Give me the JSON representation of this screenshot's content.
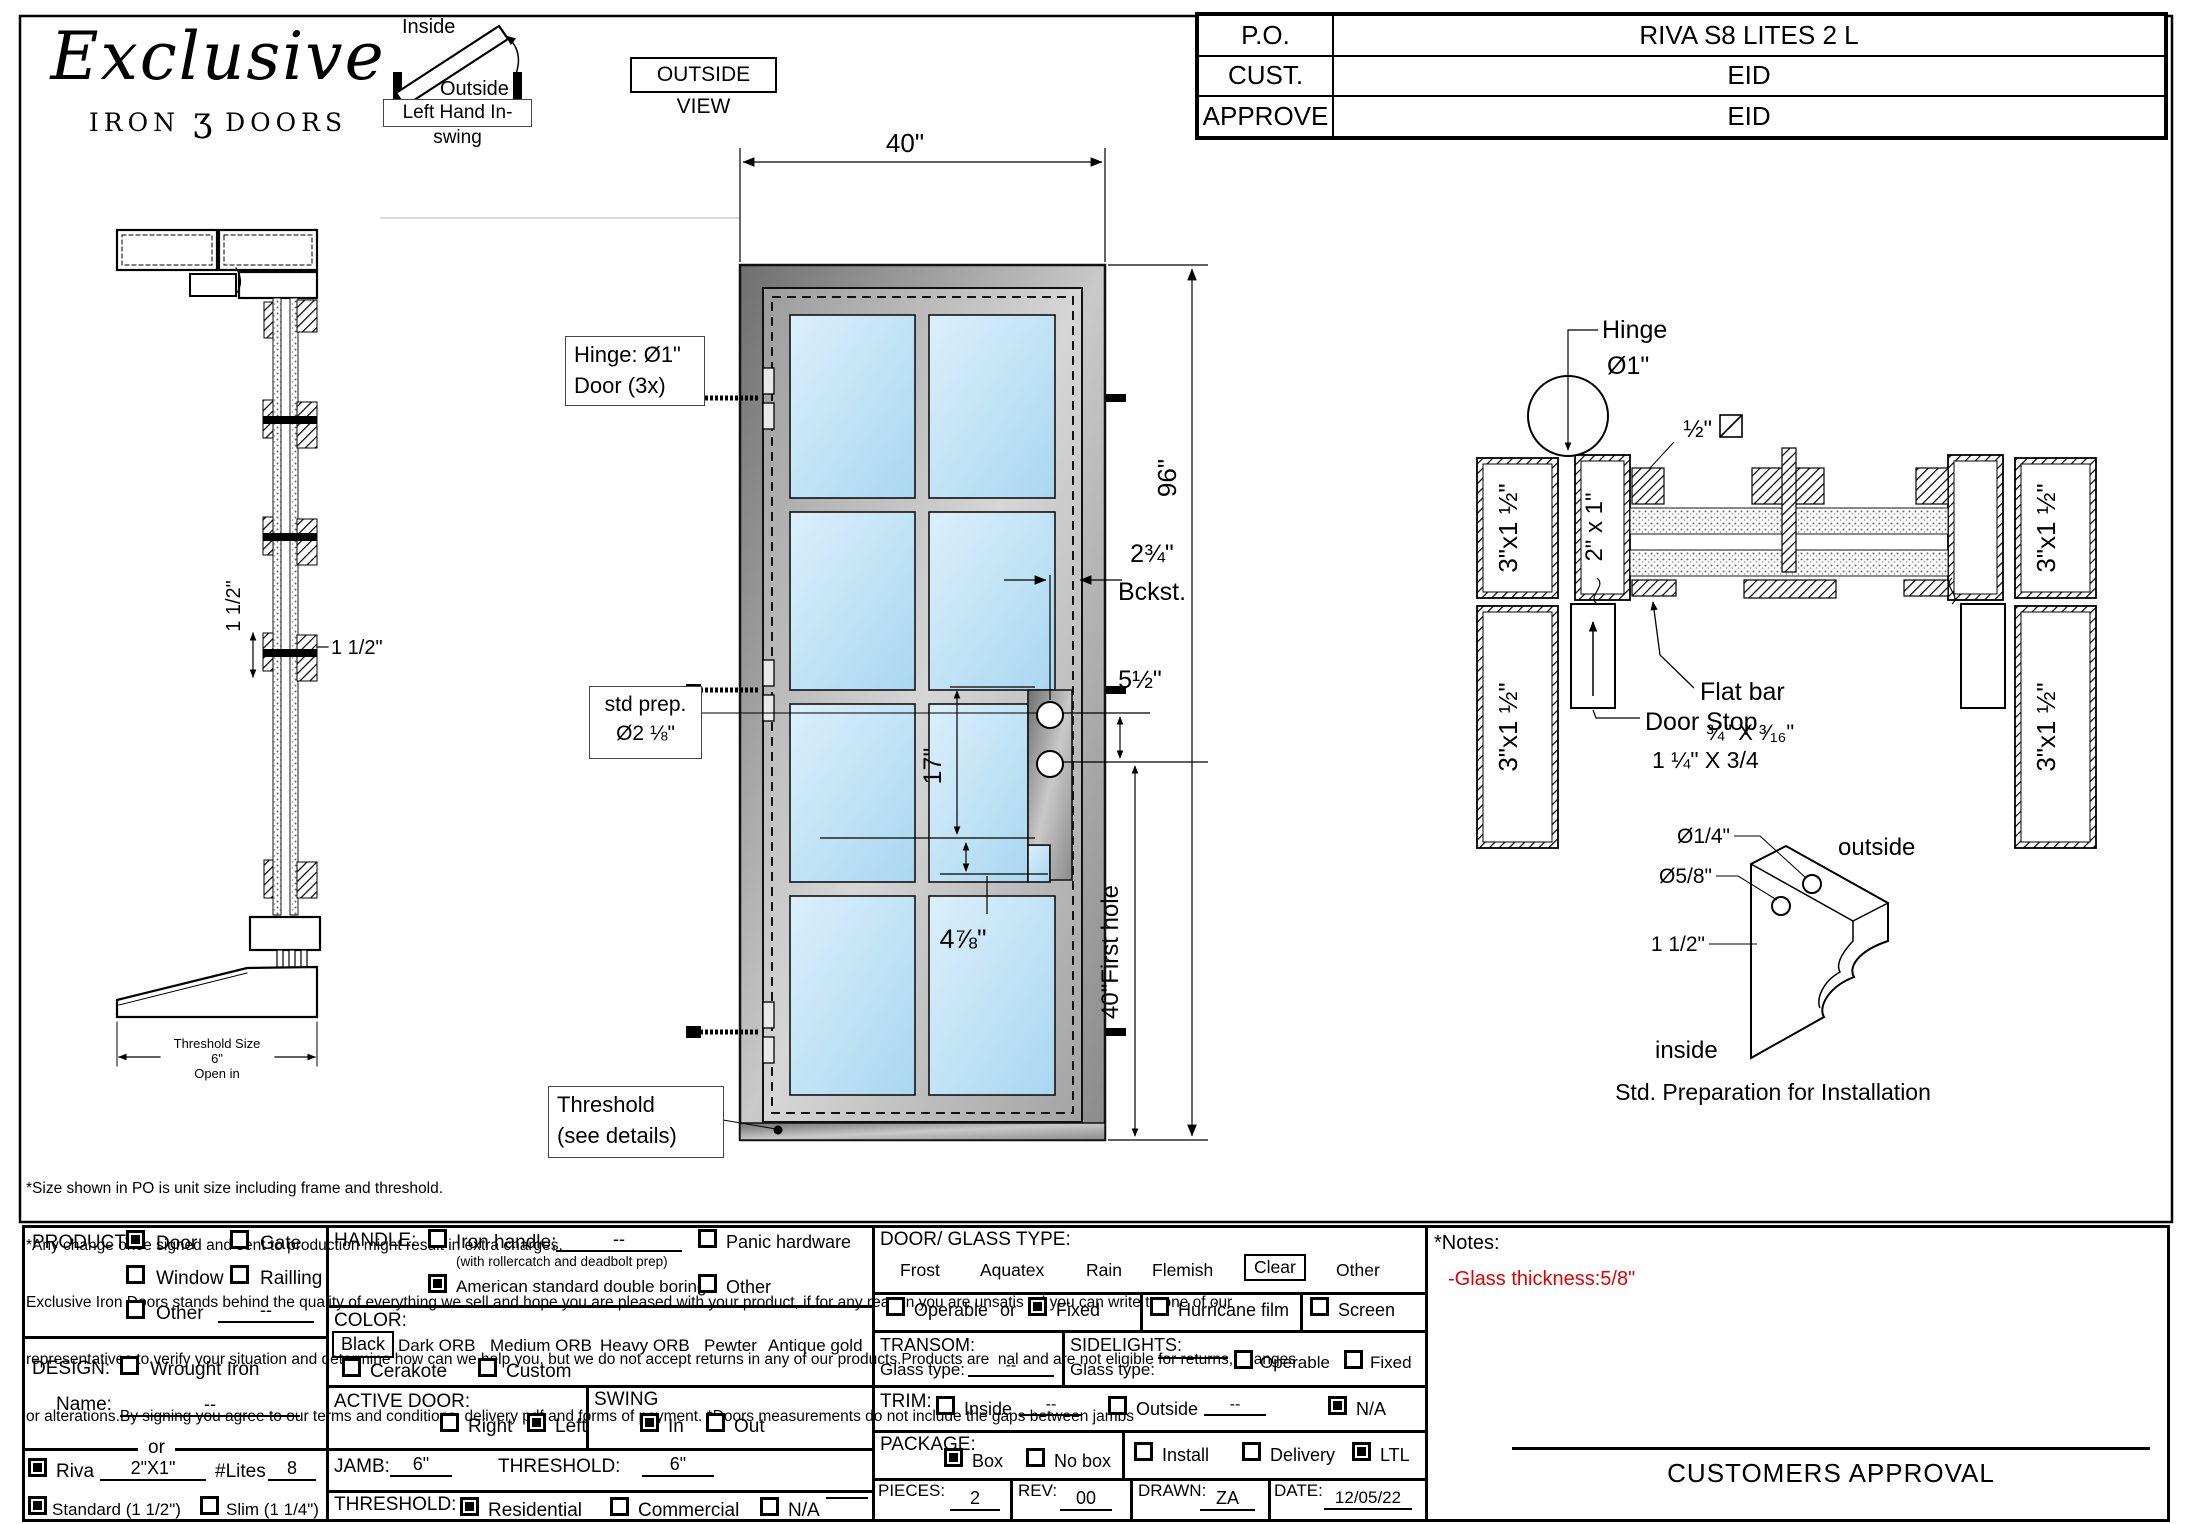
{
  "logo": {
    "name": "Exclusive",
    "iron": "IRON",
    "ornament": "ʒ",
    "doors": "DOORS"
  },
  "swing_diagram": {
    "inside": "Inside",
    "outside": "Outside",
    "caption": "Left Hand In-swing"
  },
  "view_label": "OUTSIDE VIEW",
  "po_table": {
    "r1l": "P.O.",
    "r1v": "RIVA S8 LITES 2 L",
    "r2l": "CUST.",
    "r2v": "EID",
    "r3l": "APPROVE",
    "r3v": "EID"
  },
  "elevation": {
    "width_dim": "40\"",
    "height_dim": "96\"",
    "hinge1": "Hinge: Ø1\"",
    "hinge2": "Door (3x)",
    "prep1": "std prep.",
    "prep2": "Ø2 ⅛\"",
    "backset1": "2¾\"",
    "backset2": "Bckst.",
    "five_half": "5½\"",
    "seventeen": "17\"",
    "four78": "4⅞\"",
    "first_hole": "40\"First hole",
    "thr1": "Threshold",
    "thr2": "(see details)"
  },
  "section": {
    "dim_rot": "1 1/2\"",
    "dim_h": "1 1/2\"",
    "t1": "Threshold Size",
    "t2": "6\"",
    "t3": "Open in"
  },
  "plan": {
    "hinge1": "Hinge",
    "hinge2": "Ø1\"",
    "half": "½\"",
    "tube": "2\" x 1\"",
    "jamb": "3\"x1 ½\"",
    "flat1": "Flat bar",
    "flat2": "¾\" X ³⁄₁₆\"",
    "stop1": "Door Stop",
    "stop2": "1 ¼\" X 3/4"
  },
  "corner": {
    "d14": "Ø1/4\"",
    "d58": "Ø5/8\"",
    "d112": "1 1/2\"",
    "outside": "outside",
    "inside": "inside",
    "caption": "Std. Preparation for Installation"
  },
  "disclaimer": {
    "l1": "*Size shown in PO is unit size including frame and threshold.",
    "l2": "*Any change once signed and sent to production might result in extra charges.",
    "l3": "Exclusive Iron Doors stands behind the quality of everything we sell and hope you are pleased with your product, if for any reason you are unsatis ed you can write to one of our",
    "l4": "representatives to verify your situation and determine how can we help you, but we do not accept returns in any of our products.Products are  nal and are not eligible for returns, changes",
    "l5": "or alterations.By signing you agree to our terms and conditions, delivery pdf and forms of payment. *Doors measurements do not include the gaps between jambs"
  },
  "form": {
    "product": {
      "label": "PRODUCT:",
      "door": "Door",
      "gate": "Gate",
      "window": "Window",
      "railing": "Railling",
      "other": "Other",
      "other_val": "--"
    },
    "design": {
      "label": "DESIGN:",
      "wrought": "Wrought Iron",
      "name_label": "Name:",
      "name_val": "--",
      "or": "or",
      "riva": "Riva",
      "riva_val": "2\"X1\"",
      "lites_label": "#Lites",
      "lites_val": "8",
      "standard": "Standard (1 1/2\")",
      "slim": "Slim (1 1/4\")"
    },
    "handle": {
      "label": "HANDLE:",
      "iron": "Iron handle;",
      "iron_val": "--",
      "note": "(with rollercatch and deadbolt prep)",
      "american": "American standard double boring",
      "panic": "Panic hardware",
      "other": "Other"
    },
    "color": {
      "label": "COLOR:",
      "black": "Black",
      "opt1": "Dark ORB",
      "opt2": "Medium ORB",
      "opt3": "Heavy ORB",
      "opt4": "Pewter",
      "opt5": "Antique gold",
      "cerakote": "Cerakote",
      "custom": "Custom"
    },
    "active": {
      "label": "ACTIVE DOOR:",
      "right": "Right",
      "left": "Left"
    },
    "swing": {
      "label": "SWING",
      "in": "In",
      "out": "Out"
    },
    "jamb": {
      "label": "JAMB:",
      "value": "6\"",
      "t_label": "THRESHOLD:",
      "t_value": "6\""
    },
    "threshold": {
      "label": "THRESHOLD:",
      "residential": "Residential",
      "commercial": "Commercial",
      "na": "N/A"
    },
    "glass": {
      "label": "DOOR/ GLASS TYPE:",
      "frost": "Frost",
      "aquatex": "Aquatex",
      "rain": "Rain",
      "flemish": "Flemish",
      "clear": "Clear",
      "other": "Other",
      "operable": "Operable",
      "or": "or",
      "fixed": "Fixed",
      "hurricane": "Hurricane film",
      "screen": "Screen"
    },
    "transom": {
      "label": "TRANSOM:",
      "glass_type": "Glass type:",
      "value": "--"
    },
    "sidelights": {
      "label": "SIDELIGHTS:",
      "glass_type": "Glass type:",
      "operable": "Operable",
      "fixed": "Fixed"
    },
    "trim": {
      "label": "TRIM:",
      "inside": "Inside",
      "inside_val": "--",
      "outside": "Outside",
      "outside_val": "--",
      "na": "N/A"
    },
    "package": {
      "label": "PACKAGE:",
      "box": "Box",
      "nobox": "No box",
      "install": "Install",
      "delivery": "Delivery",
      "ltl": "LTL"
    },
    "pieces": {
      "label": "PIECES:",
      "value": "2",
      "rev_label": "REV:",
      "rev": "00",
      "drawn_label": "DRAWN:",
      "drawn": "ZA",
      "date_label": "DATE:",
      "date": "12/05/22"
    }
  },
  "notes": {
    "title": "*Notes:",
    "note": "-Glass thickness:5/8\""
  },
  "approval": "CUSTOMERS APPROVAL"
}
